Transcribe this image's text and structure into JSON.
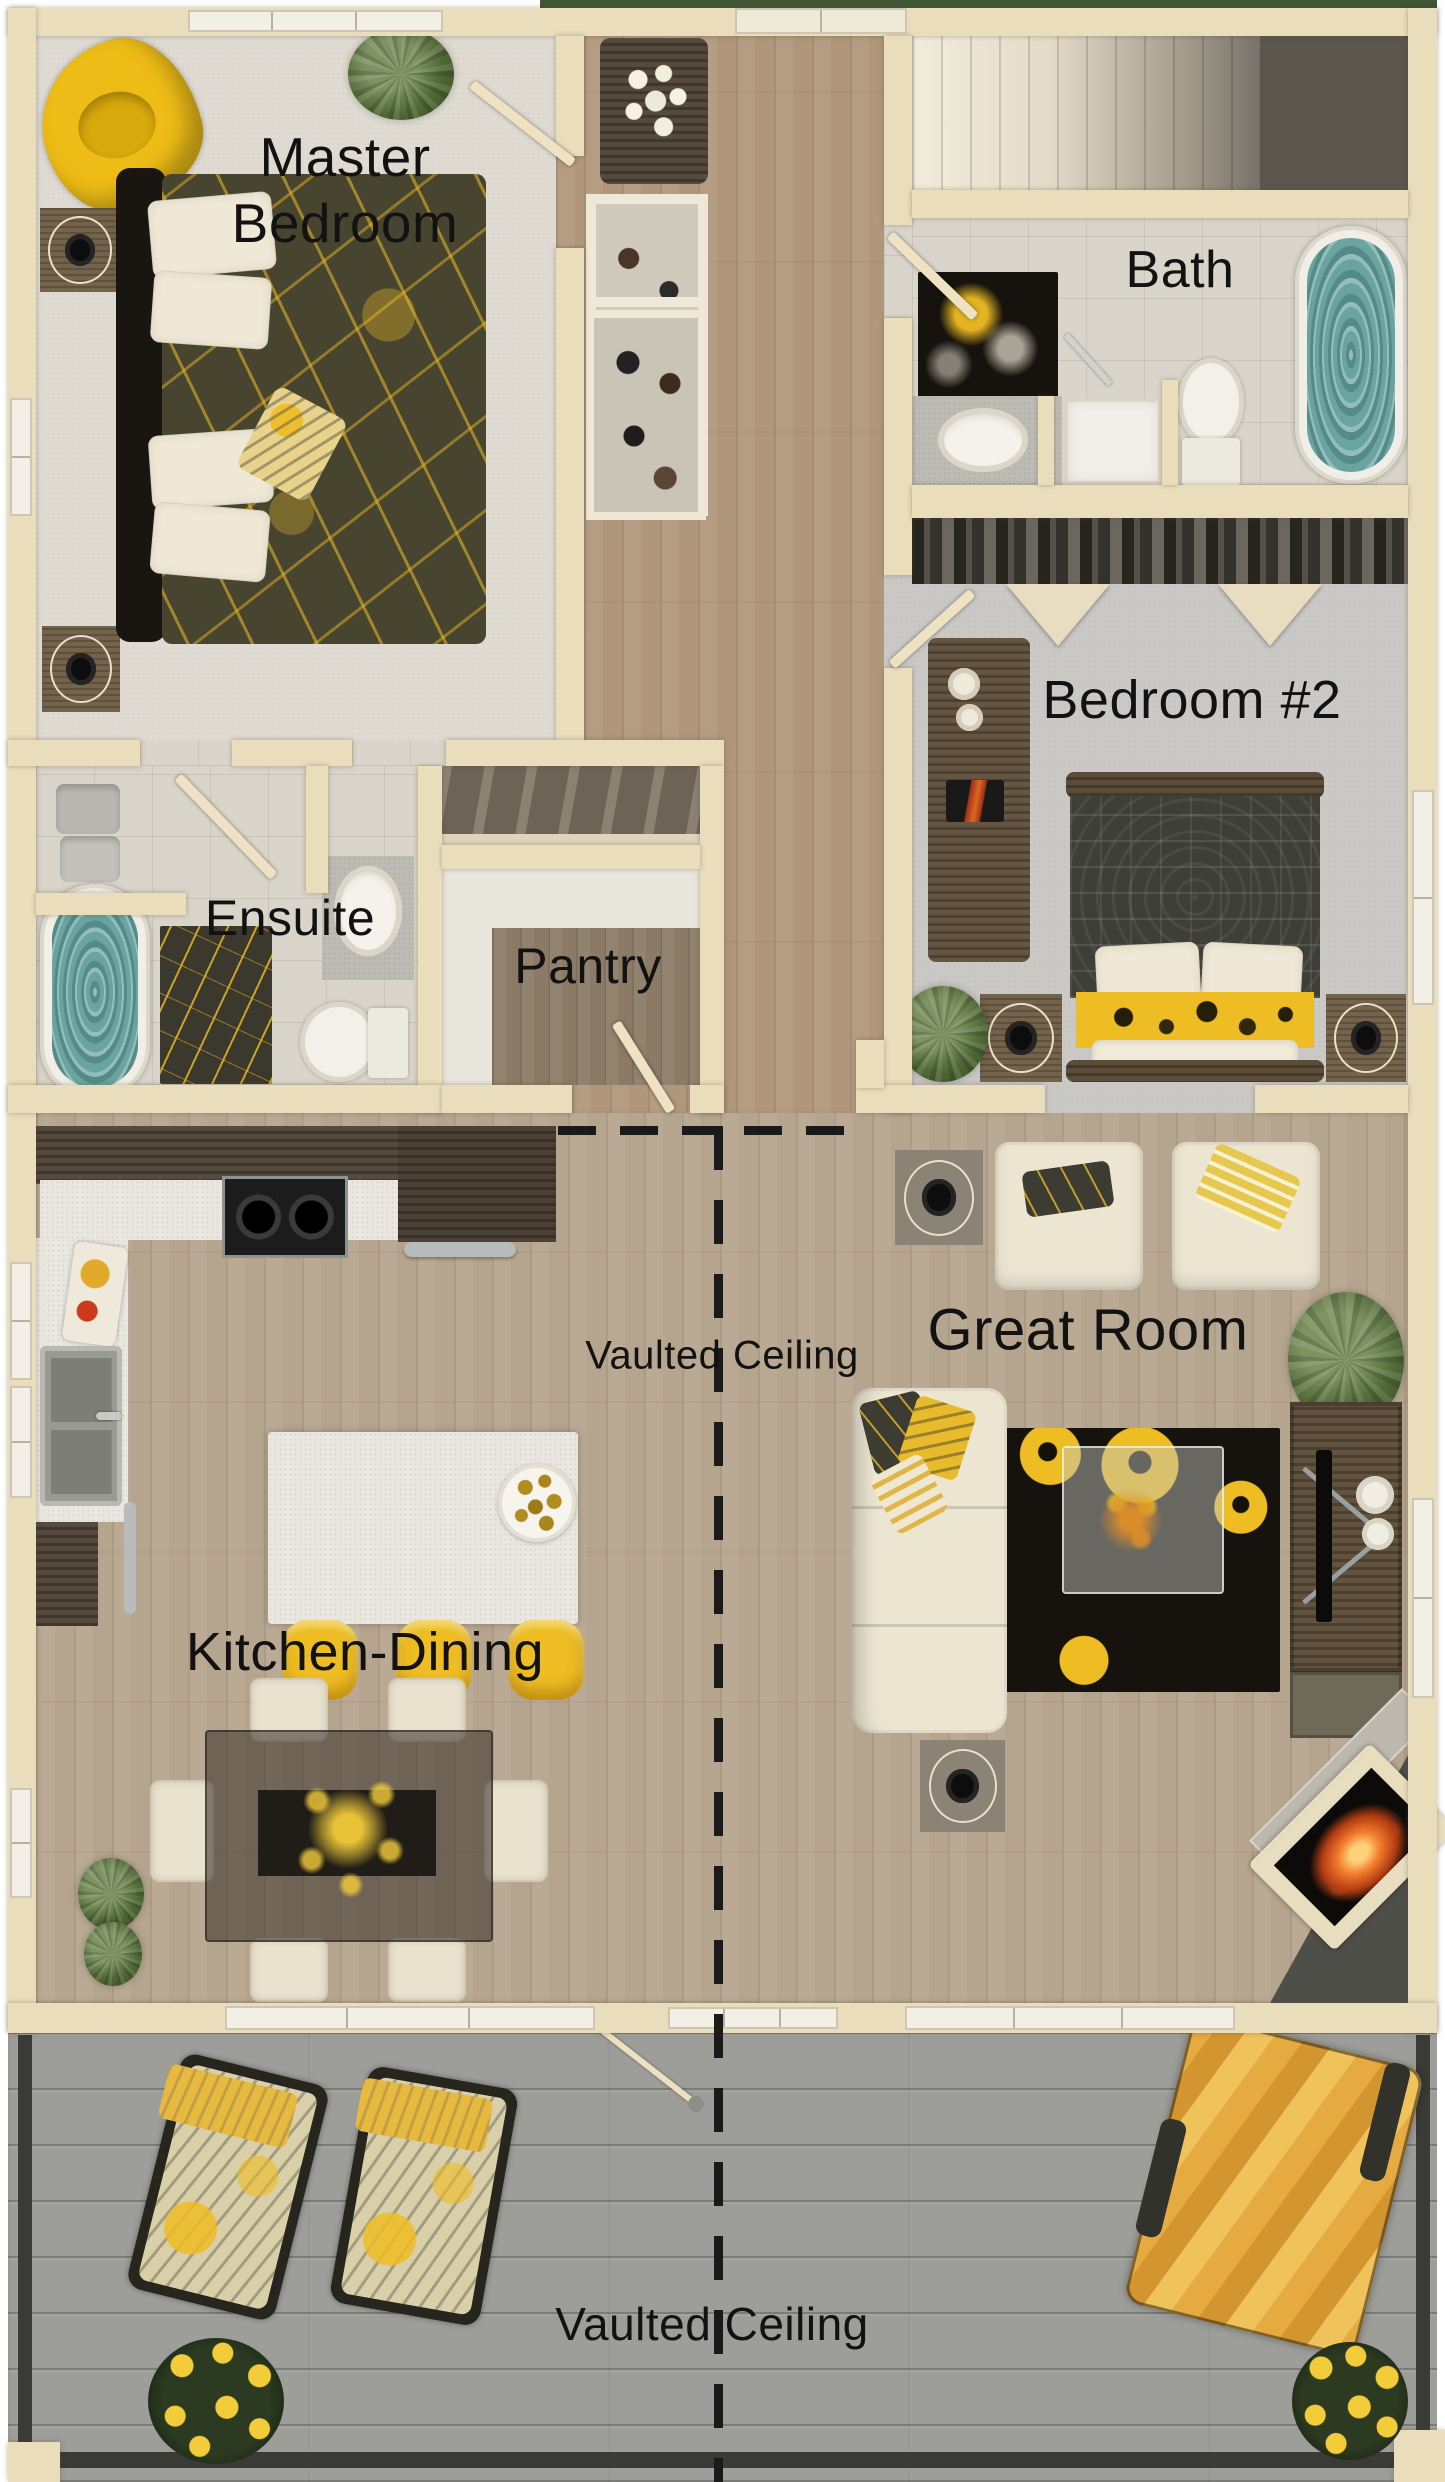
{
  "page": {
    "type": "floor-plan-rendering",
    "view": "top-down"
  },
  "labels": {
    "master_line1": "Master",
    "master_line2": "Bedroom",
    "bath": "Bath",
    "bedroom2": "Bedroom #2",
    "ensuite": "Ensuite",
    "pantry": "Pantry",
    "great_room": "Great Room",
    "kitchen_dining": "Kitchen-Dining",
    "vaulted_ceiling_main": "Vaulted Ceiling",
    "vaulted_ceiling_deck": "Vaulted Ceiling"
  },
  "colors": {
    "wall": "#e9ddbc",
    "carpet_master": "#dfdbd2",
    "carpet_bedroom2": "#cbc9c6",
    "tile": "#d9d5ca",
    "wood_hall": "#b0977b",
    "wood_main": "#b6a58e",
    "wood_dark": "#4b4034",
    "wood_pantry": "#8b7b66",
    "deck_gray": "#9d9d99",
    "railing_dark": "#3a3a37",
    "accent_yellow": "#eebc23",
    "water_teal": "#69a4a1",
    "rug_dark": "#16130e",
    "fabric_cream": "#ece5d2",
    "label_text": "#121212",
    "landing_gray": "#5b564d",
    "fire_orange": "#f37b2d",
    "foliage_green": "#36491f"
  }
}
